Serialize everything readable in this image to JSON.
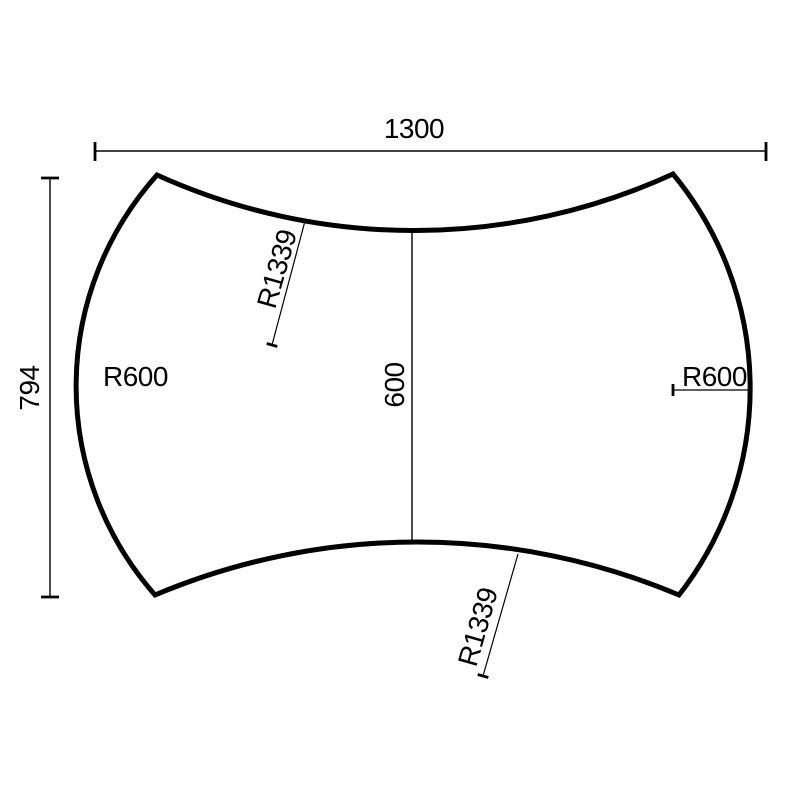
{
  "drawing": {
    "type": "technical-dimension-drawing",
    "background_color": "#ffffff",
    "line_color": "#000000",
    "labels": {
      "overall_width": "1300",
      "overall_height": "794",
      "center_height": "600",
      "left_radius": "R600",
      "right_radius": "R600",
      "top_radius": "R1339",
      "bottom_radius": "R1339"
    }
  }
}
